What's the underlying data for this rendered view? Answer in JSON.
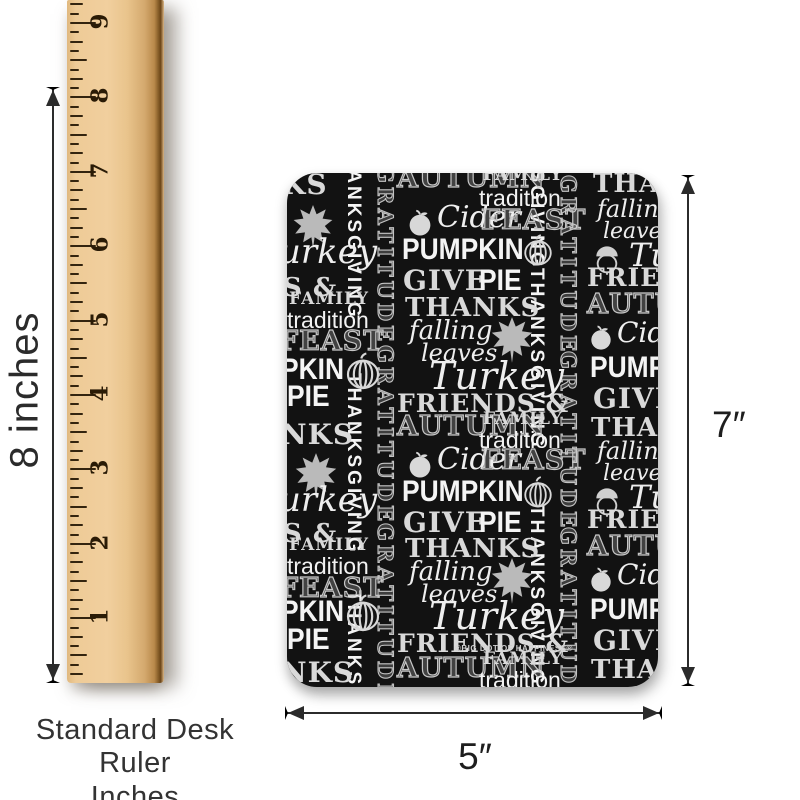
{
  "colors": {
    "background": "#ffffff",
    "card_background": "#121212",
    "chalk_white": "#f4f4f4",
    "chalk_gray": "#c6c6c6",
    "wood": "#eecb97",
    "dimension_line": "#2b2b2b",
    "tick": "#33240f"
  },
  "ruler": {
    "numbers": [
      "9",
      "8",
      "7",
      "6",
      "5",
      "4",
      "3",
      "2",
      "1"
    ],
    "caption_line1": "Standard Desk Ruler",
    "caption_line2": "Inches"
  },
  "dimensions": {
    "ruler_height_label": "8 inches",
    "card_height_label": "7″",
    "card_width_label": "5″"
  },
  "card": {
    "watermark": "®BIG DOT OF HAPPINESS®",
    "pattern": [
      {
        "t": "THANKSGIVING",
        "x": 57,
        "y": -35,
        "s": 19,
        "c": "vsol"
      },
      {
        "t": "THANKSGIVING",
        "x": 57,
        "y": 200,
        "s": 19,
        "c": "vsol"
      },
      {
        "t": "THANKSGIVING",
        "x": 57,
        "y": 417,
        "s": 19,
        "c": "vsol"
      },
      {
        "t": "GRATITUDE",
        "x": 88,
        "y": -8,
        "s": 21,
        "c": "vout"
      },
      {
        "t": "GRATITUDE",
        "x": 88,
        "y": 172,
        "s": 21,
        "c": "vout"
      },
      {
        "t": "GRATITUDE",
        "x": 88,
        "y": 350,
        "s": 21,
        "c": "vout"
      },
      {
        "t": "THANKSGIVING",
        "x": 240,
        "y": -85,
        "s": 19,
        "c": "vsol"
      },
      {
        "t": "THANKSGIVING",
        "x": 240,
        "y": 95,
        "s": 19,
        "c": "vsol"
      },
      {
        "t": "THANKSGIVING",
        "x": 240,
        "y": 332,
        "s": 19,
        "c": "vsol"
      },
      {
        "t": "GRATITUDE",
        "x": 271,
        "y": 2,
        "s": 21,
        "c": "vout"
      },
      {
        "t": "GRATITUDE",
        "x": 271,
        "y": 178,
        "s": 21,
        "c": "vout"
      },
      {
        "t": "GRATITUDE",
        "x": 271,
        "y": 354,
        "s": 21,
        "c": "vout"
      },
      {
        "t": "KS",
        "x": -6,
        "y": -2,
        "s": 28,
        "c": "chk"
      },
      {
        "i": "maple-leaf-icon",
        "x": 2,
        "y": 30,
        "w": 48
      },
      {
        "t": "urkey",
        "x": -8,
        "y": 62,
        "s": 34,
        "c": "scr"
      },
      {
        "t": "S &",
        "x": -4,
        "y": 102,
        "s": 26,
        "c": "chk"
      },
      {
        "t": "FAMILY",
        "x": 2,
        "y": 118,
        "s": 17,
        "c": "chk"
      },
      {
        "t": "tradition",
        "x": 0,
        "y": 136,
        "s": 23,
        "c": "sol2"
      },
      {
        "t": "FEAST",
        "x": -8,
        "y": 155,
        "s": 27,
        "c": "out"
      },
      {
        "t": "PKIN",
        "x": -6,
        "y": 182,
        "s": 30,
        "c": "sol"
      },
      {
        "i": "pumpkin-icon",
        "x": 56,
        "y": 178,
        "w": 40
      },
      {
        "t": "PIE",
        "x": 0,
        "y": 209,
        "s": 30,
        "c": "sol"
      },
      {
        "t": "NKS",
        "x": -6,
        "y": 248,
        "s": 28,
        "c": "chk"
      },
      {
        "i": "maple-leaf-icon",
        "x": 4,
        "y": 278,
        "w": 50
      },
      {
        "t": "urkey",
        "x": -8,
        "y": 310,
        "s": 34,
        "c": "scr"
      },
      {
        "t": "S &",
        "x": -4,
        "y": 348,
        "s": 26,
        "c": "chk"
      },
      {
        "t": "FAMILY",
        "x": 2,
        "y": 364,
        "s": 17,
        "c": "chk"
      },
      {
        "t": "tradition",
        "x": 0,
        "y": 382,
        "s": 23,
        "c": "sol2"
      },
      {
        "t": "FEAST",
        "x": -8,
        "y": 402,
        "s": 27,
        "c": "out"
      },
      {
        "t": "PKIN",
        "x": -6,
        "y": 424,
        "s": 30,
        "c": "sol"
      },
      {
        "i": "pumpkin-icon",
        "x": 56,
        "y": 420,
        "w": 40
      },
      {
        "t": "PIE",
        "x": 0,
        "y": 452,
        "s": 30,
        "c": "sol"
      },
      {
        "t": "NKS",
        "x": -6,
        "y": 486,
        "s": 28,
        "c": "chk"
      },
      {
        "t": "AUTUMN",
        "x": 110,
        "y": -8,
        "s": 27,
        "c": "out"
      },
      {
        "t": "FAMILY",
        "x": 196,
        "y": -6,
        "s": 17,
        "c": "chk"
      },
      {
        "t": "tradition",
        "x": 192,
        "y": 14,
        "s": 23,
        "c": "sol2"
      },
      {
        "i": "apple-icon",
        "x": 118,
        "y": 34,
        "w": 30
      },
      {
        "t": "Cider",
        "x": 150,
        "y": 30,
        "s": 30,
        "c": "scr"
      },
      {
        "t": "FEAST",
        "x": 194,
        "y": 34,
        "s": 27,
        "c": "out"
      },
      {
        "t": "PUMPKIN",
        "x": 115,
        "y": 62,
        "s": 30,
        "c": "sol"
      },
      {
        "i": "pumpkin-icon",
        "x": 234,
        "y": 60,
        "w": 34
      },
      {
        "t": "GIVE",
        "x": 116,
        "y": 94,
        "s": 28,
        "c": "chk"
      },
      {
        "t": "PIE",
        "x": 192,
        "y": 93,
        "s": 30,
        "c": "sol"
      },
      {
        "t": "THANKS",
        "x": 118,
        "y": 122,
        "s": 26,
        "c": "chk"
      },
      {
        "t": "falling",
        "x": 122,
        "y": 145,
        "s": 26,
        "c": "scr"
      },
      {
        "i": "maple-leaf-icon",
        "x": 200,
        "y": 142,
        "w": 50
      },
      {
        "t": "leaves",
        "x": 134,
        "y": 168,
        "s": 24,
        "c": "scr"
      },
      {
        "t": "Turkey",
        "x": 142,
        "y": 184,
        "s": 38,
        "c": "scr"
      },
      {
        "t": "FRIENDS &",
        "x": 110,
        "y": 218,
        "s": 25,
        "c": "chk"
      },
      {
        "t": "AUTUMN",
        "x": 110,
        "y": 240,
        "s": 27,
        "c": "out"
      },
      {
        "t": "FAMILY",
        "x": 196,
        "y": 238,
        "s": 17,
        "c": "chk"
      },
      {
        "t": "tradition",
        "x": 192,
        "y": 256,
        "s": 23,
        "c": "sol2"
      },
      {
        "i": "apple-icon",
        "x": 118,
        "y": 276,
        "w": 30
      },
      {
        "t": "Cider",
        "x": 150,
        "y": 272,
        "s": 30,
        "c": "scr"
      },
      {
        "t": "FEAST",
        "x": 194,
        "y": 274,
        "s": 27,
        "c": "out"
      },
      {
        "t": "PUMPKIN",
        "x": 115,
        "y": 304,
        "s": 30,
        "c": "sol"
      },
      {
        "i": "pumpkin-icon",
        "x": 234,
        "y": 302,
        "w": 34
      },
      {
        "t": "GIVE",
        "x": 116,
        "y": 336,
        "s": 28,
        "c": "chk"
      },
      {
        "t": "PIE",
        "x": 192,
        "y": 335,
        "s": 30,
        "c": "sol"
      },
      {
        "t": "THANKS",
        "x": 118,
        "y": 363,
        "s": 26,
        "c": "chk"
      },
      {
        "t": "falling",
        "x": 122,
        "y": 386,
        "s": 26,
        "c": "scr"
      },
      {
        "i": "maple-leaf-icon",
        "x": 200,
        "y": 383,
        "w": 50
      },
      {
        "t": "leaves",
        "x": 134,
        "y": 409,
        "s": 24,
        "c": "scr"
      },
      {
        "t": "Turkey",
        "x": 142,
        "y": 424,
        "s": 38,
        "c": "scr"
      },
      {
        "t": "FRIENDS &",
        "x": 110,
        "y": 458,
        "s": 25,
        "c": "chk"
      },
      {
        "t": "®BIG DOT OF HAPPINESS®",
        "x": 168,
        "y": 472,
        "s": 8,
        "c": "wm"
      },
      {
        "t": "AUTUMN",
        "x": 110,
        "y": 482,
        "s": 27,
        "c": "out"
      },
      {
        "t": "FAMILY",
        "x": 196,
        "y": 478,
        "s": 17,
        "c": "chk"
      },
      {
        "t": "tradition",
        "x": 192,
        "y": 496,
        "s": 23,
        "c": "sol2"
      },
      {
        "t": "THAN",
        "x": 306,
        "y": -2,
        "s": 26,
        "c": "chk"
      },
      {
        "t": "falling",
        "x": 310,
        "y": 24,
        "s": 24,
        "c": "scr"
      },
      {
        "t": "leaves",
        "x": 316,
        "y": 48,
        "s": 22,
        "c": "scr"
      },
      {
        "i": "acorn-icon",
        "x": 304,
        "y": 70,
        "w": 32
      },
      {
        "t": "Tu",
        "x": 342,
        "y": 66,
        "s": 32,
        "c": "scr"
      },
      {
        "t": "FRIENDS",
        "x": 300,
        "y": 92,
        "s": 25,
        "c": "chk"
      },
      {
        "t": "AUTUMN",
        "x": 300,
        "y": 118,
        "s": 27,
        "c": "out"
      },
      {
        "i": "apple-icon",
        "x": 300,
        "y": 150,
        "w": 28
      },
      {
        "t": "Cider",
        "x": 330,
        "y": 146,
        "s": 28,
        "c": "scr"
      },
      {
        "t": "PUMP",
        "x": 303,
        "y": 180,
        "s": 30,
        "c": "sol"
      },
      {
        "t": "GIVE",
        "x": 306,
        "y": 212,
        "s": 28,
        "c": "chk"
      },
      {
        "t": "THAN",
        "x": 304,
        "y": 242,
        "s": 26,
        "c": "chk"
      },
      {
        "t": "falling",
        "x": 310,
        "y": 266,
        "s": 24,
        "c": "scr"
      },
      {
        "t": "leaves",
        "x": 316,
        "y": 290,
        "s": 22,
        "c": "scr"
      },
      {
        "i": "acorn-icon",
        "x": 304,
        "y": 312,
        "w": 32
      },
      {
        "t": "Tu",
        "x": 342,
        "y": 308,
        "s": 32,
        "c": "scr"
      },
      {
        "t": "FRIENDS",
        "x": 300,
        "y": 334,
        "s": 25,
        "c": "chk"
      },
      {
        "t": "AUTUMN",
        "x": 300,
        "y": 360,
        "s": 27,
        "c": "out"
      },
      {
        "i": "apple-icon",
        "x": 300,
        "y": 392,
        "w": 28
      },
      {
        "t": "Cider",
        "x": 330,
        "y": 388,
        "s": 28,
        "c": "scr"
      },
      {
        "t": "PUMP",
        "x": 303,
        "y": 422,
        "s": 30,
        "c": "sol"
      },
      {
        "t": "GIVE",
        "x": 306,
        "y": 454,
        "s": 28,
        "c": "chk"
      },
      {
        "t": "THAN",
        "x": 304,
        "y": 484,
        "s": 26,
        "c": "chk"
      }
    ]
  }
}
